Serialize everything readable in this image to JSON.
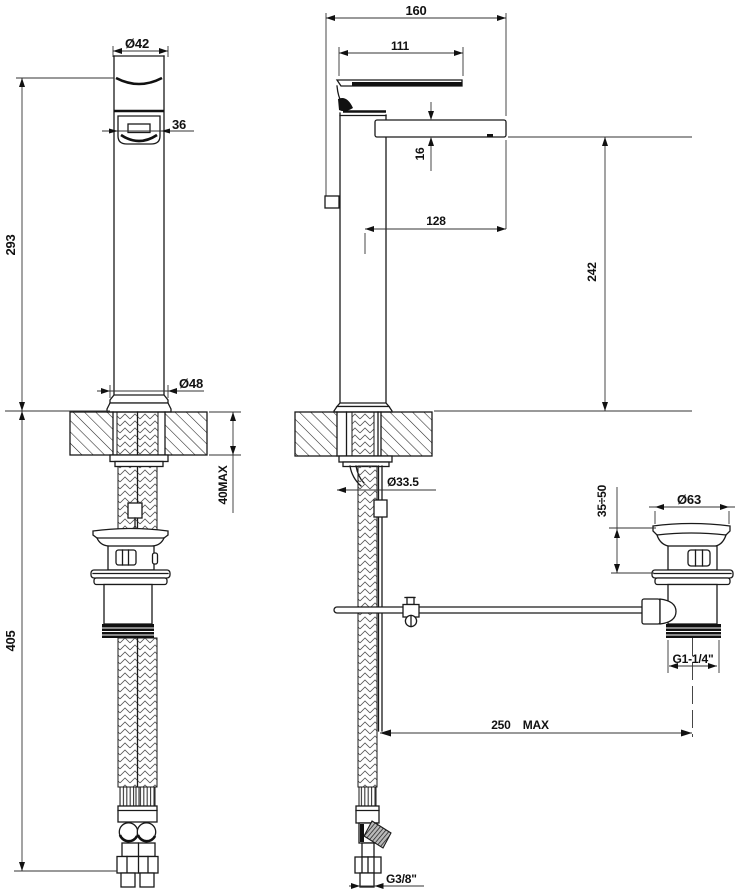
{
  "dimensions": {
    "front": {
      "cap_diameter": "Ø42",
      "handle_width": "36",
      "height_above_deck": "293",
      "base_diameter": "Ø48",
      "deck_thickness": "40MAX",
      "length_below_deck": "405"
    },
    "side": {
      "overall_depth": "160",
      "lever_length": "111",
      "spout_thickness": "16",
      "spout_reach": "128",
      "spout_height": "242",
      "shank_diameter": "Ø33.5",
      "supply_connection": "G3/8\""
    },
    "waste": {
      "flange_diameter": "Ø63",
      "deck_clamp_range": "35÷50",
      "outlet_connection": "G1-1/4\"",
      "rod_reach": "250 MAX"
    }
  }
}
